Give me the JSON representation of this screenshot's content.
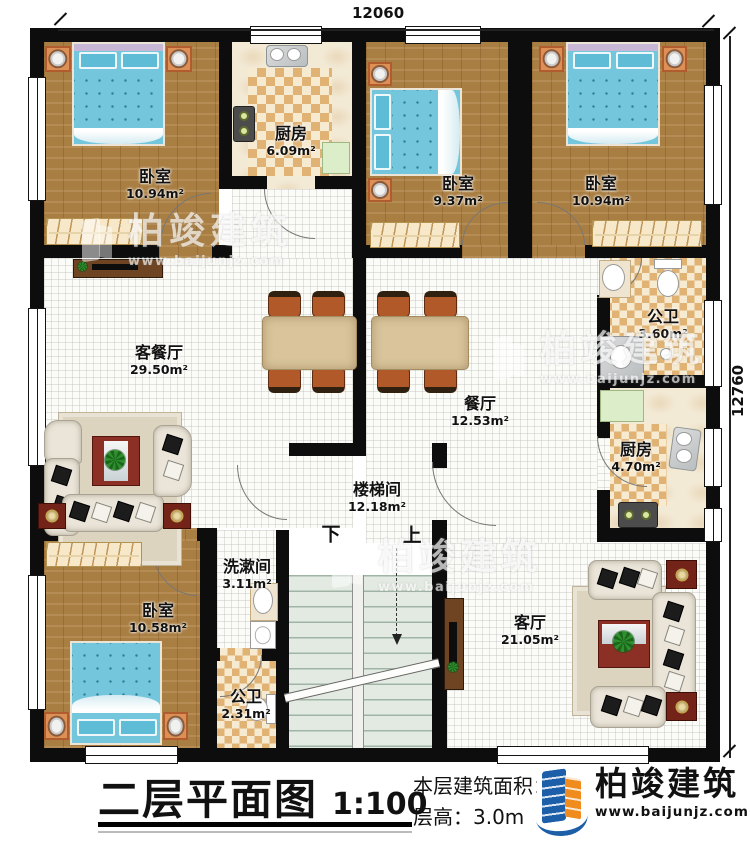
{
  "dimensions": {
    "top": "12060",
    "right": "12760"
  },
  "rooms": {
    "bedroom_tl": {
      "name": "卧室",
      "area": "10.94m²"
    },
    "kitchen_top": {
      "name": "厨房",
      "area": "6.09m²"
    },
    "bedroom_tm": {
      "name": "卧室",
      "area": "9.37m²"
    },
    "bedroom_tr": {
      "name": "卧室",
      "area": "10.94m²"
    },
    "living_dining": {
      "name": "客餐厅",
      "area": "29.50m²"
    },
    "dining": {
      "name": "餐厅",
      "area": "12.53m²"
    },
    "bath_upper": {
      "name": "公卫",
      "area": "3.60m²"
    },
    "kitchen_right": {
      "name": "厨房",
      "area": "4.70m²"
    },
    "stairwell": {
      "name": "楼梯间",
      "area": "12.18m²"
    },
    "washroom": {
      "name": "洗漱间",
      "area": "3.11m²"
    },
    "bath_lower": {
      "name": "公卫",
      "area": "2.31m²"
    },
    "bedroom_bl": {
      "name": "卧室",
      "area": "10.58m²"
    },
    "living": {
      "name": "客厅",
      "area": "21.05m²"
    }
  },
  "stairs": {
    "down": "下",
    "up": "上"
  },
  "footer": {
    "title": "二层平面图",
    "scale": "1:100",
    "area_label": "本层建筑面积：",
    "area_value": "159.59m²",
    "height_label": "层高：",
    "height_value": "3.0m"
  },
  "brand": {
    "name": "柏竣建筑",
    "site": "www.baijunjz.com"
  },
  "colors": {
    "wall": "#0d0d0d",
    "wood": "#a97e43",
    "tile_dark": "#e0b273",
    "tile_light": "#f6ead0",
    "accent_blue": "#1c5fa8",
    "accent_orange": "#f08c1e"
  }
}
